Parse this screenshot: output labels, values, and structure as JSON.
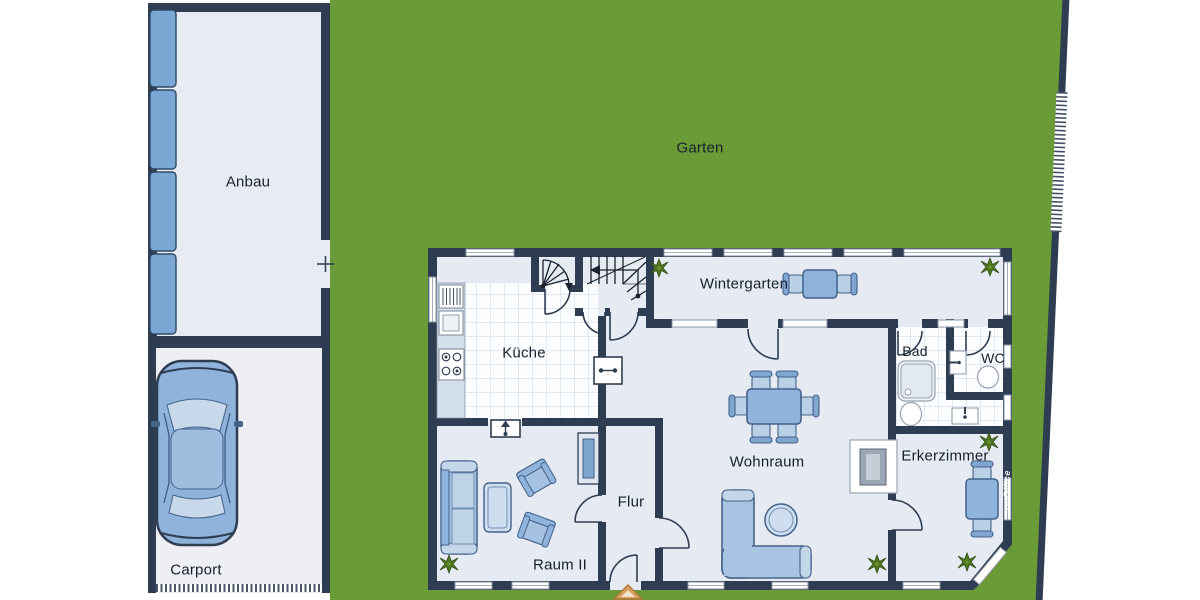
{
  "plan": {
    "outdoor": {
      "garden": "Garten"
    },
    "annex": {
      "label": "Anbau"
    },
    "carport": {
      "label": "Carport"
    },
    "rooms": {
      "kitchen": "Küche",
      "winter_garden": "Wintergarten",
      "bath": "Bad",
      "wc": "WC",
      "living_room": "Wohnraum",
      "bay_room": "Erkerzimmer",
      "hallway": "Flur",
      "room_two": "Raum II"
    },
    "watermark": "onOffice",
    "colors": {
      "wall": "#2e3d52",
      "garden": "#6b9b36",
      "floor": "#e6eaf2",
      "tile_line": "#c9d5e5",
      "furniture": "#8fb3da",
      "furniture_light": "#c3d6ea",
      "window_panel": "#7ba7d4",
      "plant": "#4e7a1f",
      "entrance_marker": "#d9a05e"
    }
  }
}
